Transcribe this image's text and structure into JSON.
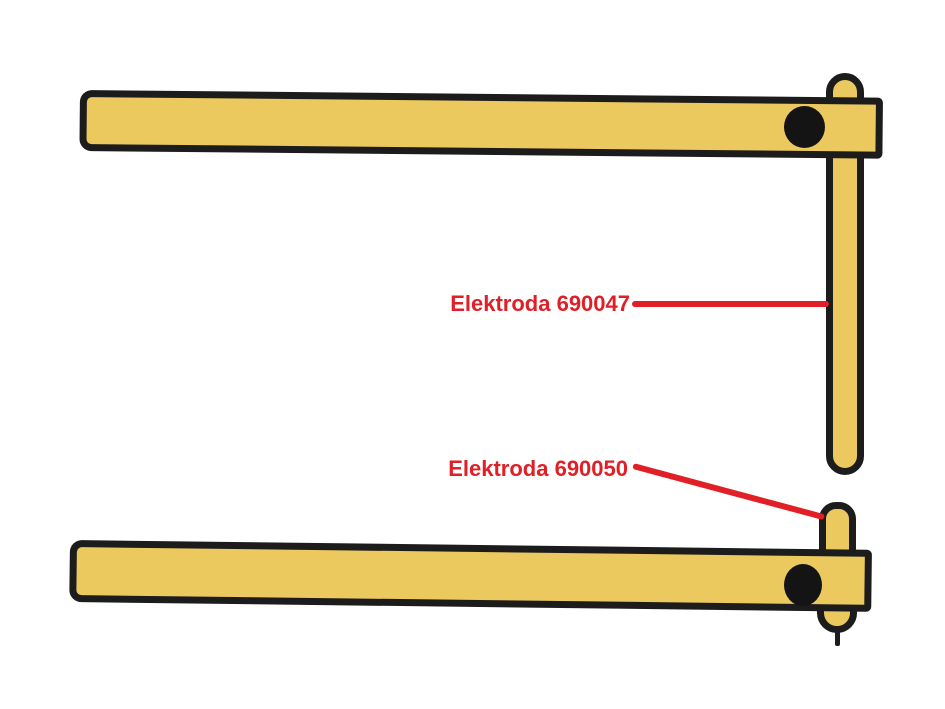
{
  "colors": {
    "background": "#ffffff",
    "part-fill": "#ECC95E",
    "outline": "#1C1C1C",
    "hole": "#141414",
    "accent": "#E11F26"
  },
  "diagram": {
    "annotations": [
      {
        "text": "Elektroda 690047",
        "target": "long-electrode"
      },
      {
        "text": "Elektroda 690050",
        "target": "short-electrode"
      }
    ]
  }
}
